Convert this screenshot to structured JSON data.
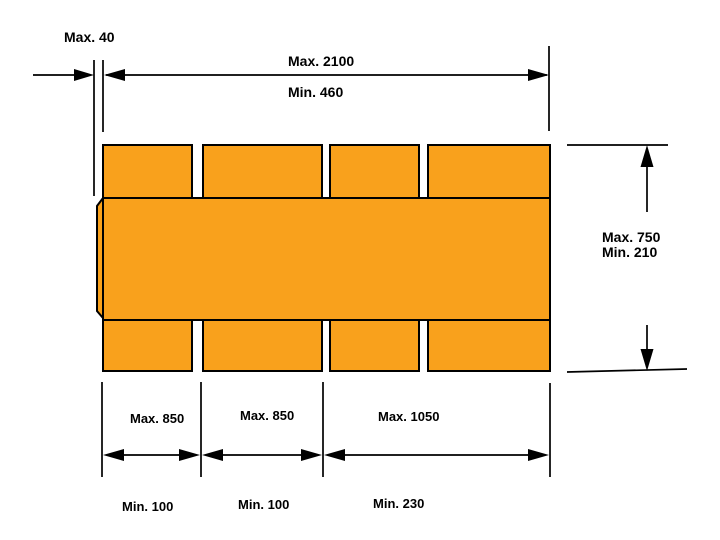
{
  "page": {
    "background": "#ffffff"
  },
  "diagram": {
    "type": "carton-blank-dimension-drawing",
    "shape": {
      "fill": "#F9A11C",
      "stroke": "#000000"
    },
    "dimensions": {
      "glue_flap": {
        "label": "Max. 40"
      },
      "overall_length": {
        "max": "Max. 2100",
        "min": "Min. 460"
      },
      "height": {
        "max": "Max. 750",
        "min": "Min. 210"
      },
      "panel_1": {
        "max": "Max. 850",
        "min": "Min. 100"
      },
      "panel_2": {
        "max": "Max. 850",
        "min": "Min. 100"
      },
      "panel_3": {
        "max": "Max. 1050",
        "min": "Min. 230"
      }
    }
  }
}
